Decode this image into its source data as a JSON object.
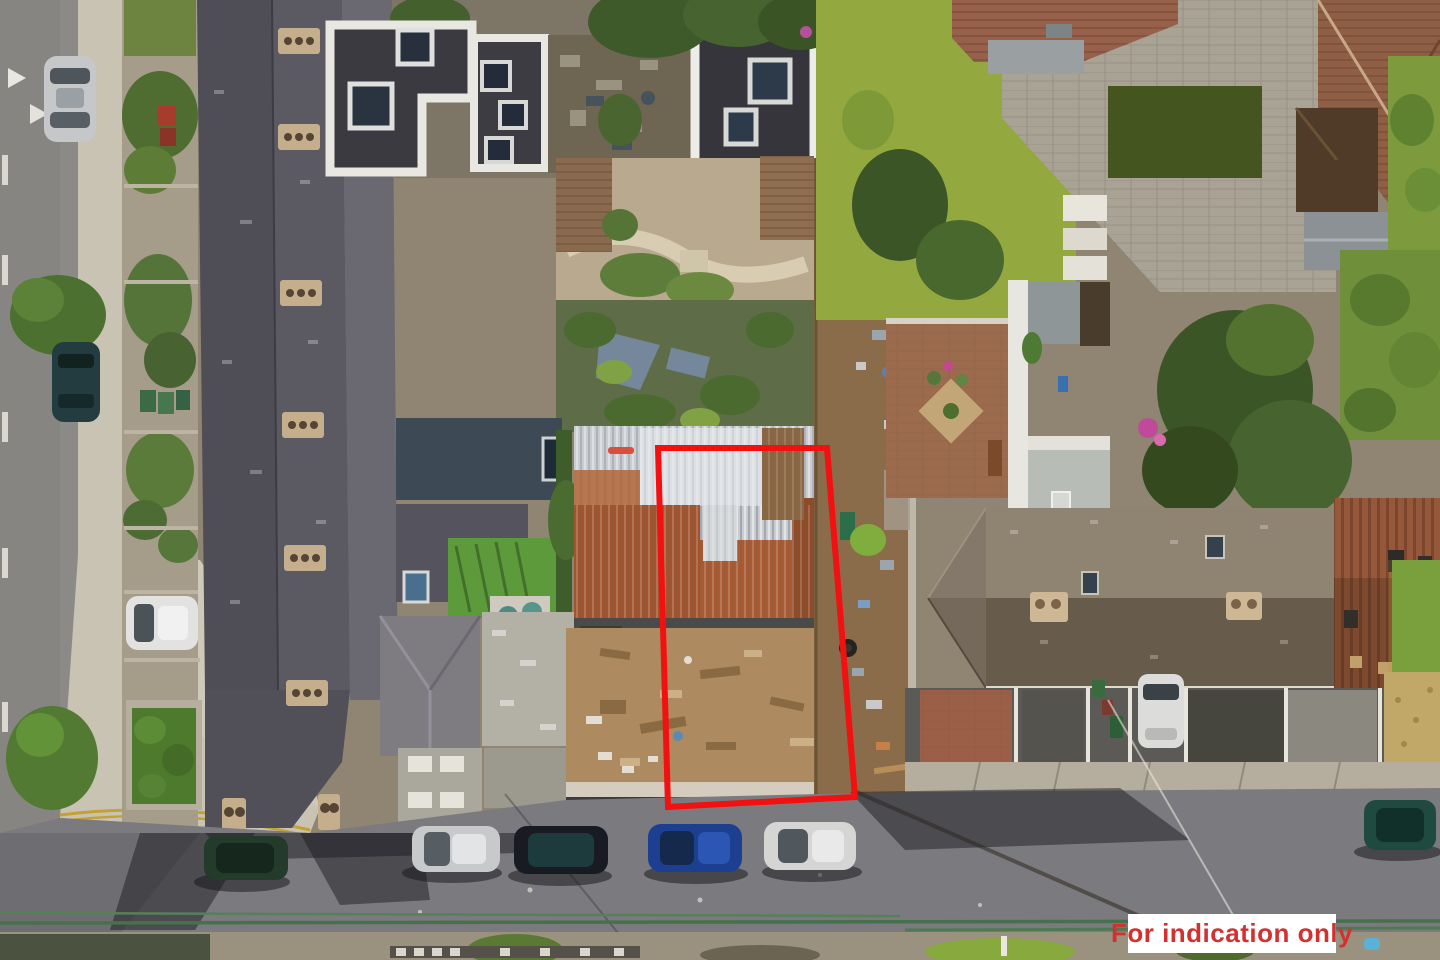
{
  "scene": {
    "width": 1440,
    "height": 960,
    "description": "Aerial drone photo of an urban infill development site; red outline marks the plot boundary"
  },
  "overlay": {
    "boundary": {
      "points": "658,448 827,448 855,797 668,807",
      "color": "#f21010",
      "stroke_width": 6
    },
    "disclaimer": {
      "label": "For indication only",
      "text_color": "#d23130",
      "bg_color": "#ffffff"
    }
  },
  "palette": {
    "left_road": "#8b8a86",
    "bottom_road": "#7b7a7e",
    "sidewalk": "#c9c3b4",
    "slate_roof": "#53515a",
    "hip_roof_light": "#8f8372",
    "hip_roof_dark": "#675b4b",
    "corrugated_metal": "#c9ccd1",
    "rust": "#a1552f",
    "dirt_yard": "#ad8a5f",
    "junk_lane": "#8a6b4a",
    "lawn": "#93a83e",
    "tree": "#3f5a2a",
    "terracotta_roof": "#96604a",
    "courtyard_paving": "#9c6a4c",
    "railing_green": "#47704c"
  }
}
